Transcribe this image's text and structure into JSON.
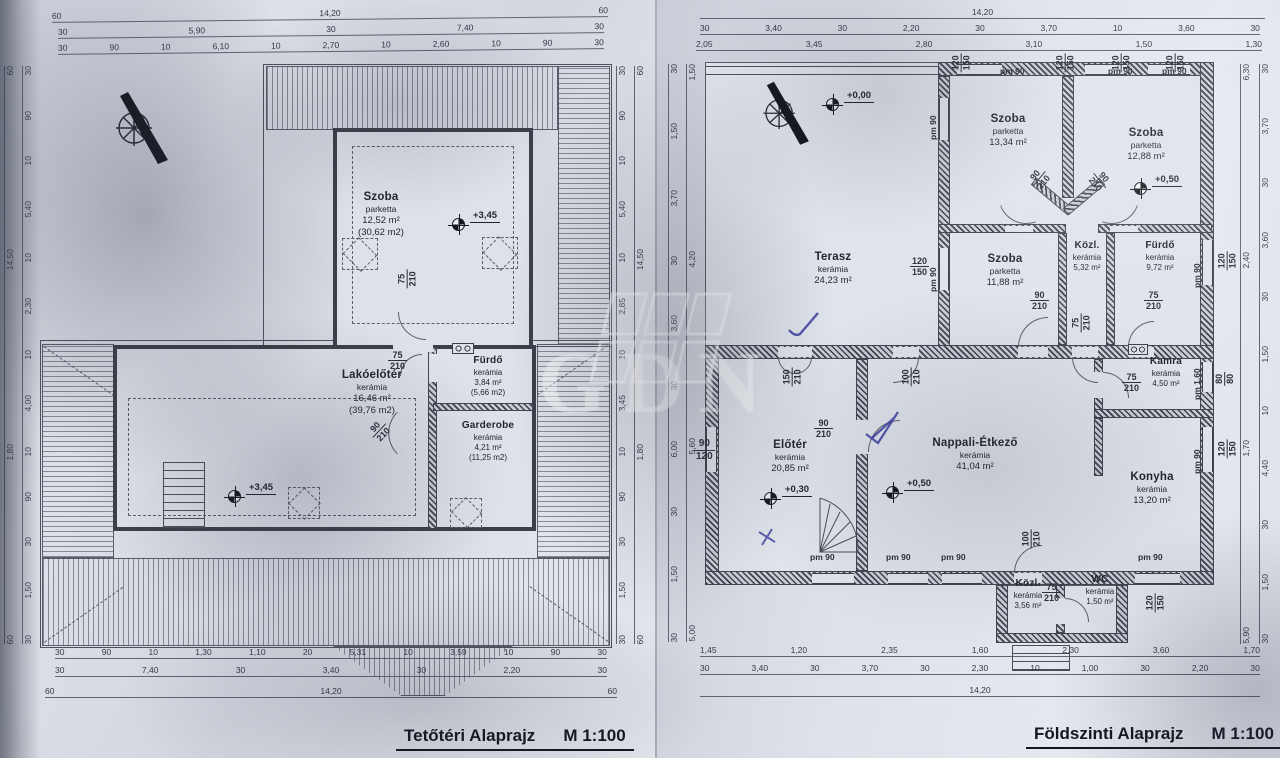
{
  "palette": {
    "paper": "#dde1e9",
    "ink": "#32363f",
    "pen_blue": "#3a3e9f"
  },
  "watermark": {
    "text": "GDN"
  },
  "attic": {
    "title": "Tetőtéri Alaprajz",
    "scale": "M 1:100",
    "rooms": {
      "szoba": {
        "name": "Szoba",
        "finish": "parketta",
        "area": "12,52 m²",
        "area_gross": "(30,62 m2)"
      },
      "lakoeloter": {
        "name": "Lakóelőtér",
        "finish": "kerámia",
        "area": "16,46 m²",
        "area_gross": "(39,76 m2)"
      },
      "furdo": {
        "name": "Fürdő",
        "finish": "kerámia",
        "area": "3,84 m²",
        "area_gross": "(5,66 m2)"
      },
      "garderobe": {
        "name": "Garderobe",
        "finish": "kerámia",
        "area": "4,21 m²",
        "area_gross": "(11,25 m2)"
      }
    },
    "elevations": {
      "upper": "+3,45",
      "lower": "+3,45"
    },
    "doors": {
      "d75": [
        "75",
        "210"
      ],
      "d90": [
        "90",
        "210"
      ]
    },
    "dims": {
      "top1": [
        "60",
        "14,20",
        "60"
      ],
      "top2": [
        "30",
        "5,90",
        "30",
        "7,40",
        "30"
      ],
      "top3": [
        "30",
        "90",
        "10",
        "6,10",
        "10",
        "2,70",
        "10",
        "2,60",
        "10",
        "90",
        "30"
      ],
      "bottom1": [
        "30",
        "90",
        "10",
        "1,30",
        "1,10",
        "20",
        "5,31",
        "10",
        "3,59",
        "10",
        "90",
        "30"
      ],
      "bottom2": [
        "30",
        "7,40",
        "30",
        "3,40",
        "30",
        "2,20",
        "30"
      ],
      "bottom3": [
        "60",
        "14,20",
        "60"
      ],
      "left_outer": [
        "60",
        "14,50",
        "1,80",
        "60"
      ],
      "left_inner": [
        "30",
        "90",
        "10",
        "5,40",
        "10",
        "2,30",
        "10",
        "4,00",
        "10",
        "90",
        "30",
        "1,50",
        "30"
      ],
      "right_inner": [
        "30",
        "90",
        "10",
        "5,40",
        "10",
        "2,85",
        "10",
        "3,45",
        "10",
        "90",
        "30",
        "1,50",
        "30"
      ],
      "right_outer": [
        "60",
        "14,50",
        "1,80",
        "60"
      ]
    }
  },
  "ground": {
    "title": "Földszinti Alaprajz",
    "scale": "M 1:100",
    "rooms": {
      "szoba1": {
        "name": "Szoba",
        "finish": "parketta",
        "area": "13,34 m²"
      },
      "szoba2": {
        "name": "Szoba",
        "finish": "parketta",
        "area": "12,88 m²"
      },
      "szoba3": {
        "name": "Szoba",
        "finish": "parketta",
        "area": "11,88 m²"
      },
      "kozl1": {
        "name": "Közl.",
        "finish": "kerámia",
        "area": "5,32 m²"
      },
      "furdo": {
        "name": "Fürdő",
        "finish": "kerámia",
        "area": "9,72 m²"
      },
      "terasz": {
        "name": "Terasz",
        "finish": "kerámia",
        "area": "24,23 m²"
      },
      "kamra": {
        "name": "Kamra",
        "finish": "kerámia",
        "area": "4,50 m²"
      },
      "eloter": {
        "name": "Előtér",
        "finish": "kerámia",
        "area": "20,85 m²"
      },
      "nappali": {
        "name": "Nappali-Étkező",
        "finish": "kerámia",
        "area": "41,04 m²"
      },
      "konyha": {
        "name": "Konyha",
        "finish": "kerámia",
        "area": "13,20 m²"
      },
      "kozl2": {
        "name": "Közl.",
        "finish": "kerámia",
        "area": "3,56 m²"
      },
      "wc": {
        "name": "WC",
        "finish": "kerámia",
        "area": "1,50 m²"
      }
    },
    "elevations": {
      "zero": "+0,00",
      "first": "+0,50",
      "living": "+0,50",
      "entry": "+0,30"
    },
    "doors": {
      "d90": [
        "90",
        "210"
      ],
      "d75": [
        "75",
        "210"
      ],
      "d150": [
        "150",
        "210"
      ],
      "d100": [
        "100",
        "210"
      ]
    },
    "windows": {
      "pm90": "pm 90",
      "pm160": "pm 1,60",
      "s120150": [
        "120",
        "150"
      ],
      "s8080": [
        "80",
        "80"
      ],
      "s90120": [
        "90",
        "120"
      ]
    },
    "dims": {
      "top1": [
        "14,20"
      ],
      "top2": [
        "30",
        "3,40",
        "30",
        "2,20",
        "30",
        "3,70",
        "10",
        "3,60",
        "30"
      ],
      "top3": [
        "2,05",
        "3,45",
        "2,80",
        "3,10",
        "1,50",
        "1,30"
      ],
      "bottom1": [
        "1,45",
        "1,20",
        "2,35",
        "1,60",
        "2,30",
        "3,60",
        "1,70"
      ],
      "bottom2": [
        "30",
        "3,40",
        "30",
        "3,70",
        "30",
        "2,30",
        "10",
        "1,00",
        "30",
        "2,20",
        "30"
      ],
      "bottom3": [
        "14,20"
      ],
      "left_outer": [
        "30",
        "1,50",
        "3,70",
        "30",
        "3,60",
        "30",
        "6,00",
        "30",
        "1,50",
        "30"
      ],
      "left_inner": [
        "1,50",
        "4,20",
        "5,60",
        "5,00"
      ],
      "right_inner": [
        "6,30",
        "2,40",
        "1,70",
        "5,90"
      ],
      "right_outer": [
        "30",
        "3,70",
        "30",
        "3,60",
        "30",
        "1,50",
        "10",
        "4,40",
        "30",
        "1,50",
        "30"
      ]
    }
  }
}
